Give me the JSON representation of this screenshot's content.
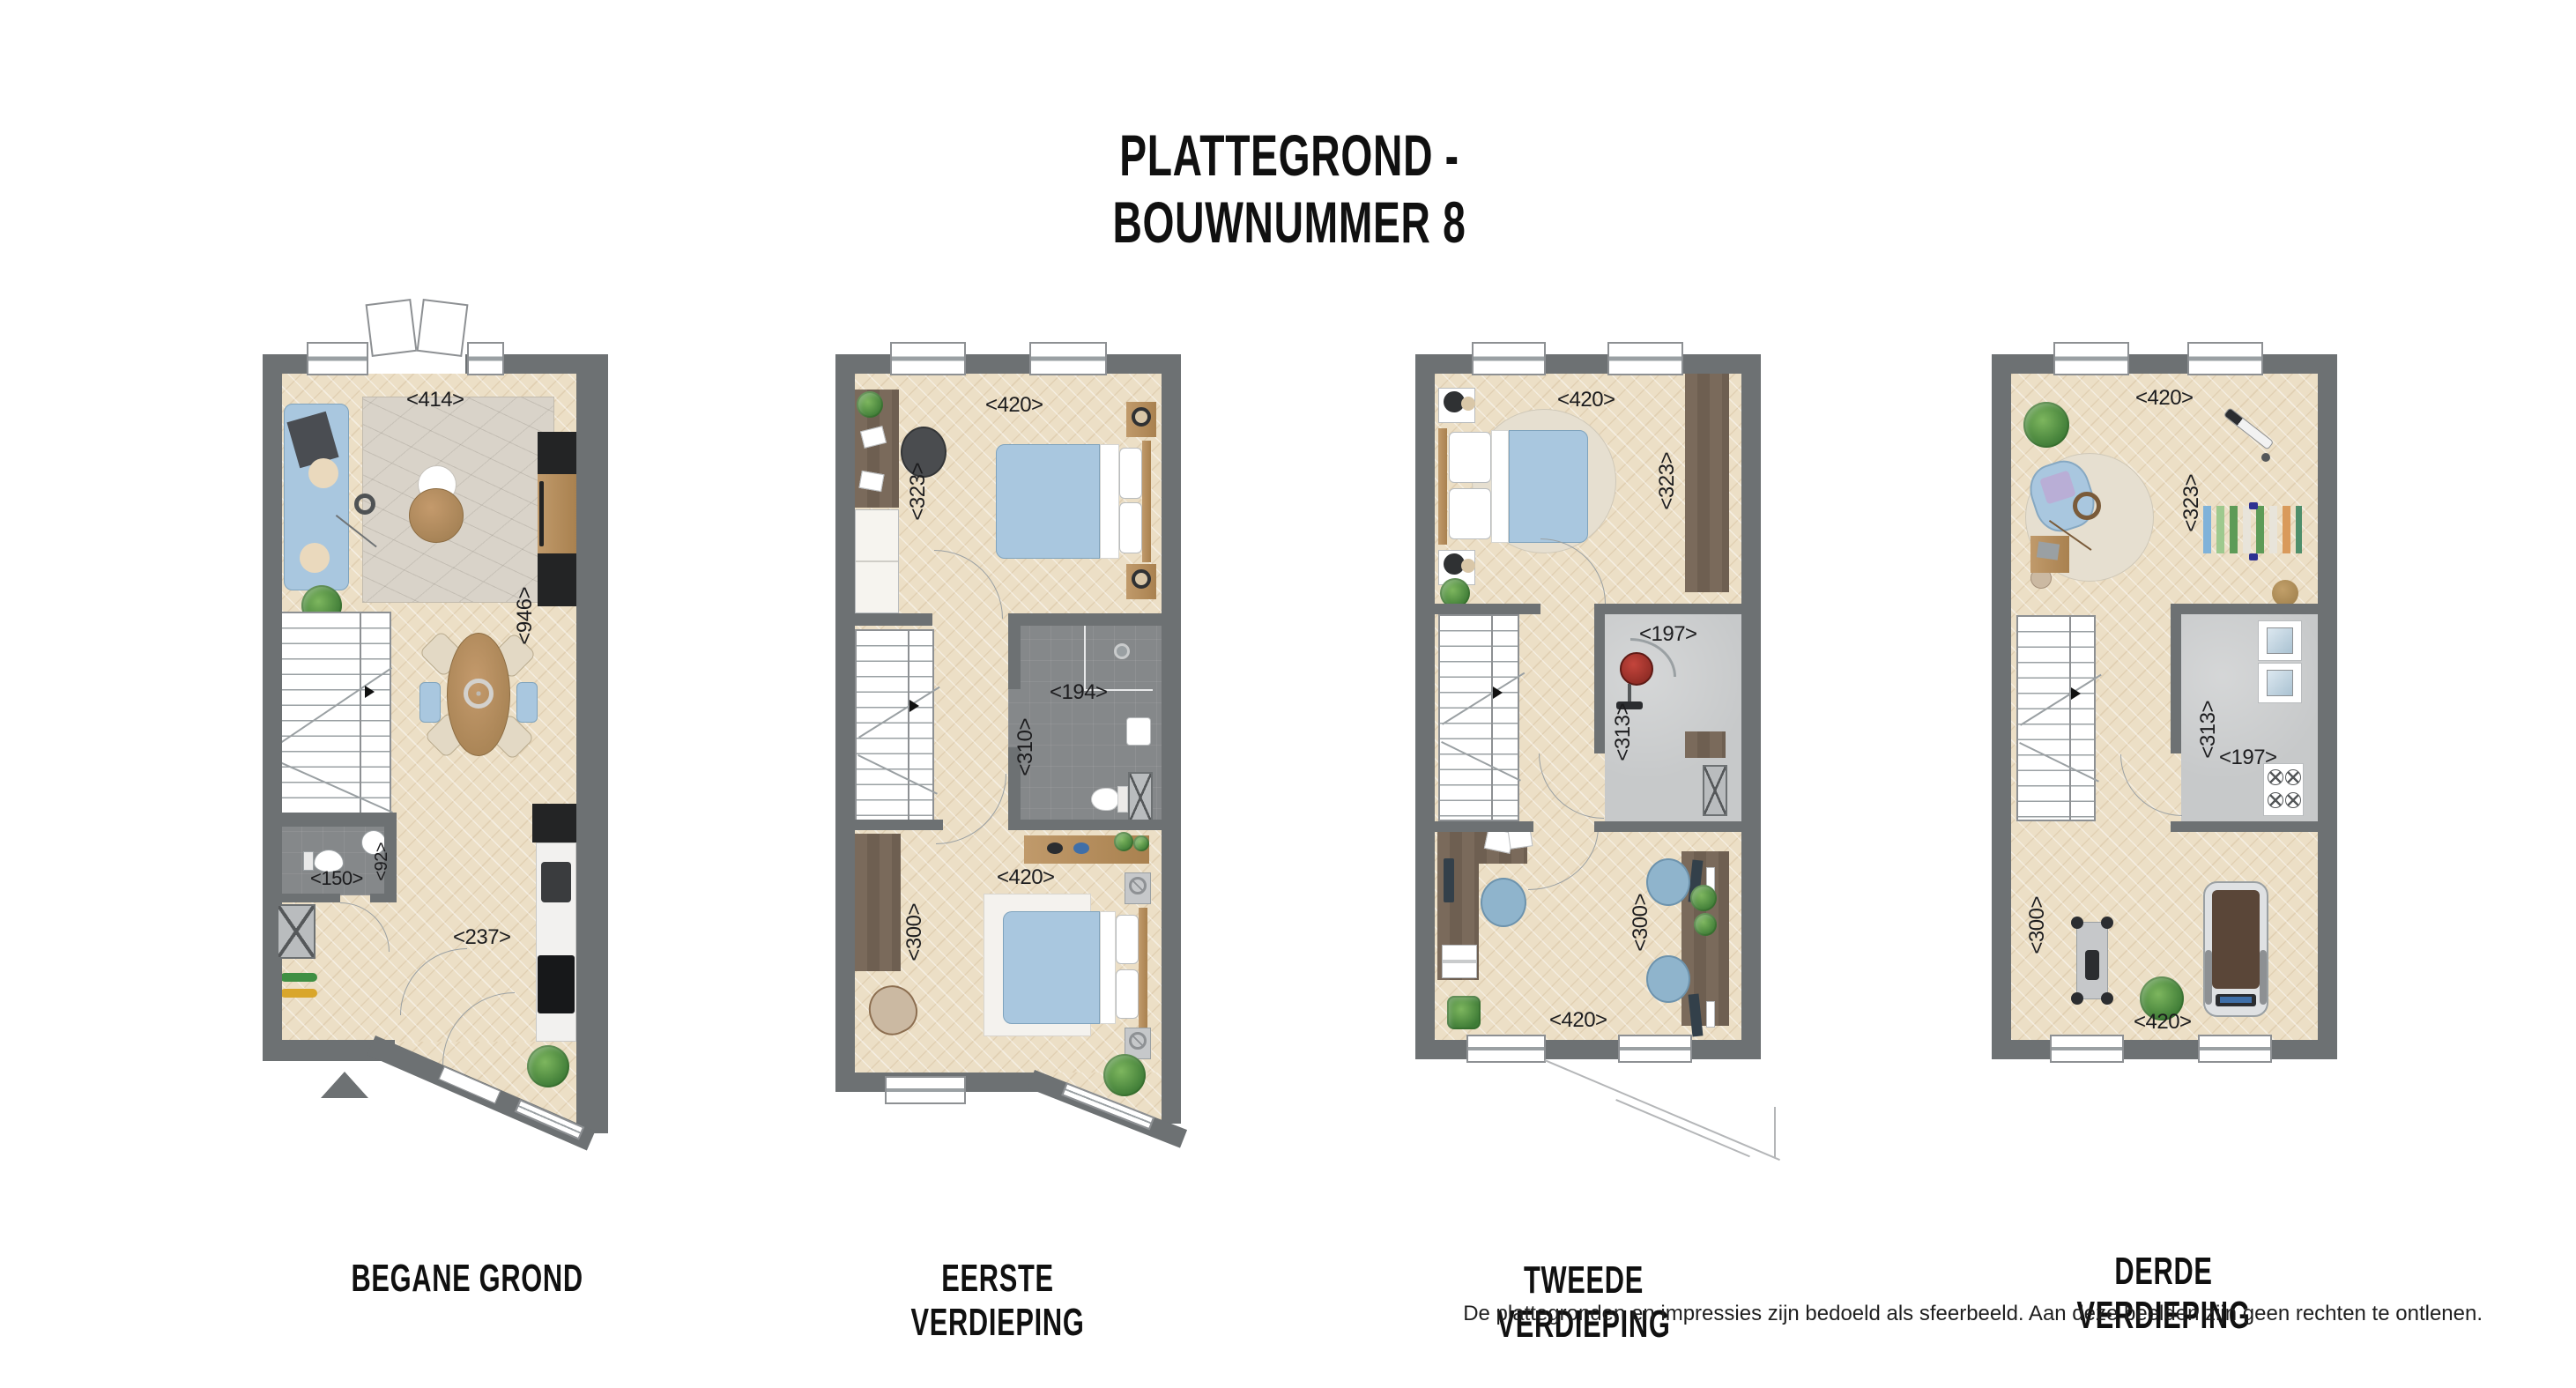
{
  "title": "PLATTEGROND - BOUWNUMMER 8",
  "disclaimer": "De plattegronden en impressies zijn bedoeld als sfeerbeeld. Aan deze beelden zijn geen rechten te ontlenen.",
  "colors": {
    "wall": "#6d7173",
    "floor": "#ecdfc6",
    "floorD": "#85888a",
    "floorG": "#c7c9ca",
    "blue": "#a9c7df",
    "wood": "#b68b5c",
    "dwood": "#74665a",
    "rug": "#d9d3c9",
    "green": "#4c8f44",
    "red": "#b03a31",
    "kblack": "#232425",
    "ink": "#1c1c1e"
  },
  "floors": [
    {
      "name": "BEGANE GROND",
      "dims": [
        "<414>",
        "<946>",
        "<150>",
        "<92>",
        "<237>"
      ]
    },
    {
      "name": "EERSTE VERDIEPING",
      "dims": [
        "<420>",
        "<323>",
        "<194>",
        "<310>",
        "<420>",
        "<300>"
      ]
    },
    {
      "name": "TWEEDE VERDIEPING",
      "dims": [
        "<420>",
        "<323>",
        "<197>",
        "<313>",
        "<300>",
        "<420>"
      ]
    },
    {
      "name": "DERDE VERDIEPING",
      "dims": [
        "<420>",
        "<323>",
        "<313>",
        "<197>",
        "<300>",
        "<420>"
      ]
    }
  ]
}
